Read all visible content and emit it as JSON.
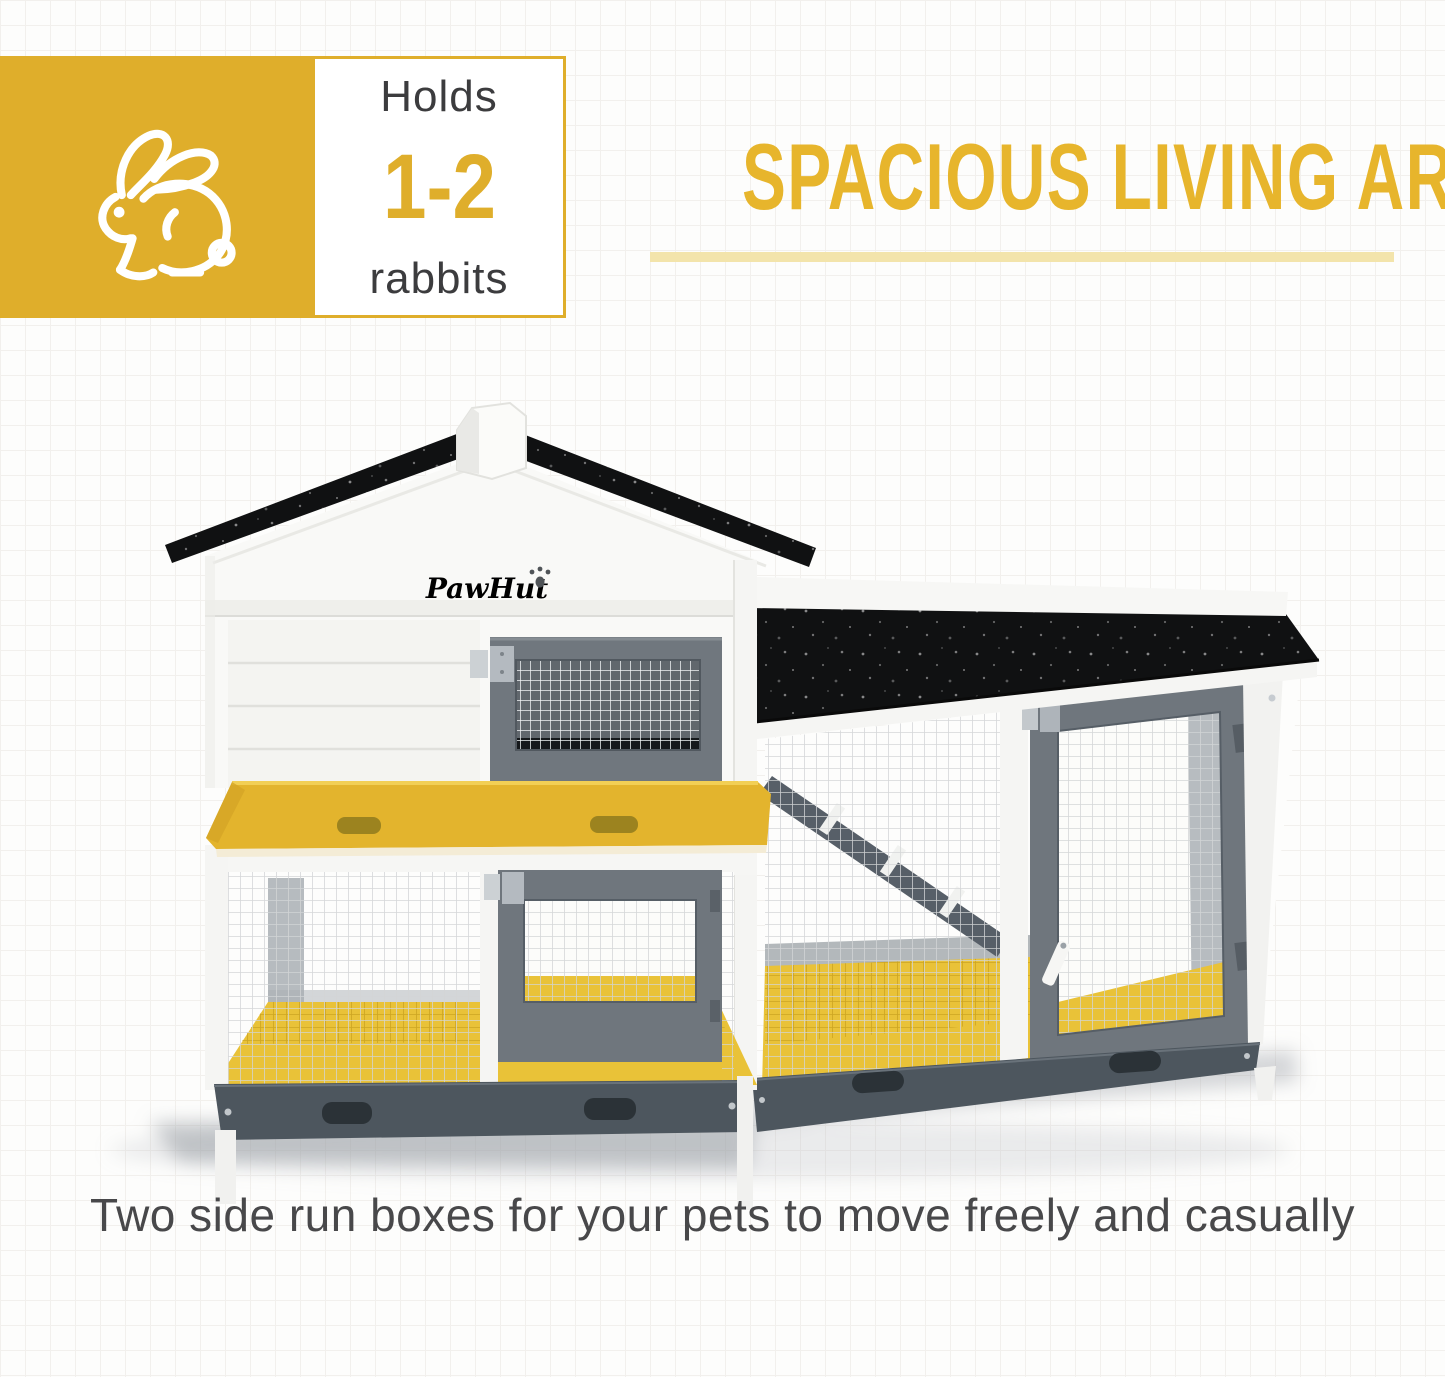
{
  "badge": {
    "holds_label": "Holds",
    "capacity": "1-2",
    "animal_label": "rabbits"
  },
  "heading": {
    "title": "SPACIOUS LIVING AREA"
  },
  "product": {
    "brand": "PawHut"
  },
  "caption": {
    "text": "Two side run boxes for your pets to move freely and casually"
  },
  "icons": {
    "badge_icon": "rabbit-outline-icon"
  },
  "colors": {
    "accent_yellow": "#DFAE2B",
    "heading_yellow": "#E7B52C",
    "pale_underline": "#F3E4AB",
    "roof_black": "#101112",
    "frame_gray": "#6F767D",
    "floor_yellow": "#E9C238",
    "base_gray": "#4D565E",
    "text_dark": "#3C3C3E"
  }
}
